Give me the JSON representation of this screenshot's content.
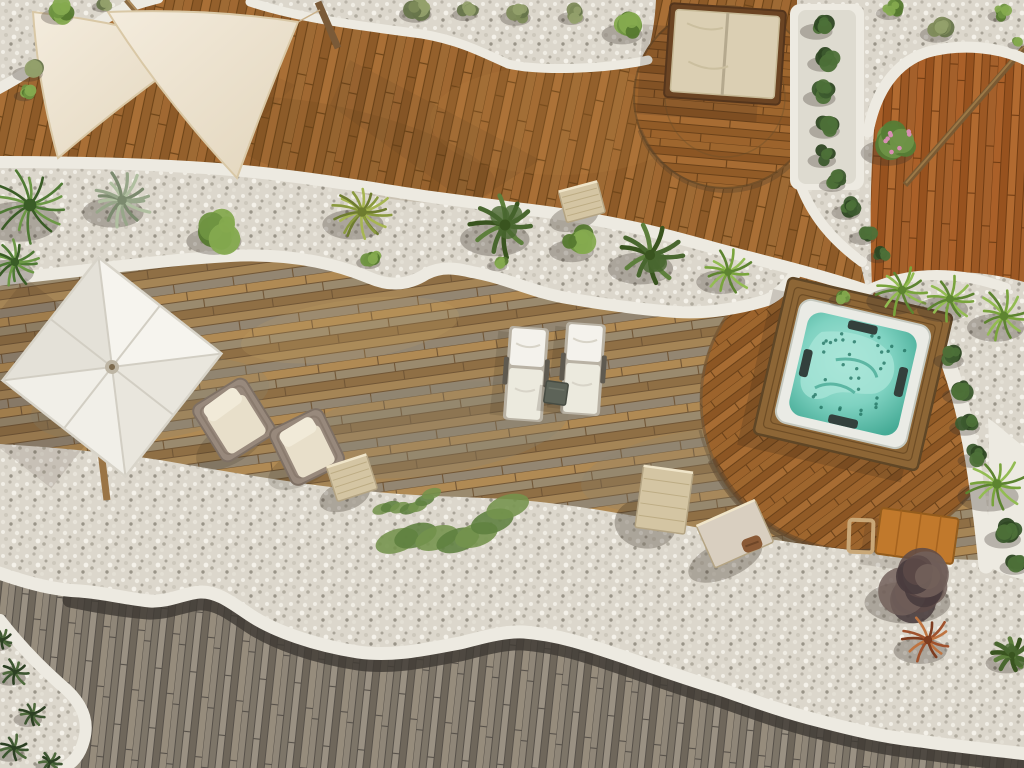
{
  "meta": {
    "title": "Aerial drone view of a curved luxury rooftop terrace with jacuzzi, sun loungers and white pebble beds",
    "description": "Top-down photograph: organic curved wooden decks separated by white concrete curbs and white gravel planting bands, a square hot tub with turquoise water, two white sun loungers, a white square parasol, cream shade sails, a daybed on a circular deck, wicker armchairs and green plants."
  },
  "palette": {
    "gravel": "#dcd7cc",
    "curb": "#edeae1",
    "curb_shadow": "#d6d2c6",
    "deck_upper": "#9b6530",
    "deck_right": "#a35c26",
    "deck_circle": "#975f2a",
    "deck_mid": "#a98a58",
    "deck_lower": "#8c8376",
    "deck_gap_dark": "#3f3b34",
    "sail": "#ece2ce",
    "sail_edge": "#d9c8a6",
    "umbrella": "#f3f1ea",
    "daybed_frame": "#6b4423",
    "daybed_cushion": "#dbcfb3",
    "wicker": "#98897c",
    "cushion": "#e8dfca",
    "lounger": "#f4f2ec",
    "table_dark": "#5d6358",
    "jacuzzi_wood": "#8d6636",
    "jacuzzi_rim": "#eaebe5",
    "water": "#7fd2c1",
    "water_light": "#a9e6d8",
    "water_deep": "#46ab96",
    "jet_dot": "#1f6f5e",
    "bench": "#c1792c",
    "stone": "#d4c5a3",
    "slab": "#d9cfc0",
    "towel": "#8a5a36",
    "shadow": "#2e2418",
    "pole_wood": "#8a6a42"
  },
  "scene": {
    "plant_styles": {
      "bush": [
        "#6f9441",
        "#85aa4f",
        "#55782f"
      ],
      "olive-bush": [
        "#7d8a58",
        "#93a06b",
        "#66744a"
      ],
      "hedge": [
        "#3c5a2e",
        "#4d7038",
        "#2e4723"
      ],
      "flower-bush": [
        "#567c36",
        "#6f9447",
        "#d88fb4"
      ],
      "shrub-dark": [
        "#5d4a48",
        "#72605a",
        "#463a3c"
      ],
      "fern": [
        "#49672f",
        "#5d7f3c",
        "#39541f"
      ],
      "fan-palm": [
        "#4f7a34",
        "#6c9845",
        "#3a5c26"
      ],
      "palm-frond": [
        "#79a43c",
        "#93bc52",
        "#5d8430"
      ],
      "agave": [
        "#97a689",
        "#b0bfa0",
        "#7b8a6e"
      ],
      "yucca": [
        "#8a9a3e",
        "#a7b652",
        "#6e7c2f"
      ],
      "creeper": [
        "#5d7f3f",
        "#74934c",
        "#49672f"
      ],
      "grass-tuft": [
        "#3c5530",
        "#4e6a3c",
        "#2c4023"
      ],
      "red-grass": [
        "#a0522d",
        "#bf7440",
        "#7e3c1f"
      ]
    },
    "plants": [
      {
        "kind": "fan-palm",
        "x": 30,
        "y": 205,
        "r": 40
      },
      {
        "kind": "fan-palm",
        "x": 15,
        "y": 262,
        "r": 26
      },
      {
        "kind": "agave",
        "x": 122,
        "y": 200,
        "r": 30
      },
      {
        "kind": "bush",
        "x": 222,
        "y": 230,
        "r": 27
      },
      {
        "kind": "yucca",
        "x": 362,
        "y": 212,
        "r": 30
      },
      {
        "kind": "fern",
        "x": 505,
        "y": 225,
        "r": 34
      },
      {
        "kind": "bush",
        "x": 578,
        "y": 242,
        "r": 22
      },
      {
        "kind": "fern",
        "x": 650,
        "y": 255,
        "r": 32
      },
      {
        "kind": "palm-frond",
        "x": 728,
        "y": 272,
        "r": 24
      },
      {
        "kind": "bush",
        "x": 843,
        "y": 296,
        "r": 11
      },
      {
        "kind": "bush",
        "x": 372,
        "y": 258,
        "r": 12
      },
      {
        "kind": "bush",
        "x": 500,
        "y": 262,
        "r": 10
      },
      {
        "kind": "olive-bush",
        "x": 420,
        "y": 8,
        "r": 16
      },
      {
        "kind": "olive-bush",
        "x": 468,
        "y": 10,
        "r": 12
      },
      {
        "kind": "olive-bush",
        "x": 520,
        "y": 12,
        "r": 15
      },
      {
        "kind": "olive-bush",
        "x": 575,
        "y": 13,
        "r": 13
      },
      {
        "kind": "bush",
        "x": 628,
        "y": 26,
        "r": 20
      },
      {
        "kind": "olive-bush",
        "x": 32,
        "y": 68,
        "r": 15
      },
      {
        "kind": "bush",
        "x": 27,
        "y": 92,
        "r": 10
      },
      {
        "kind": "bush",
        "x": 62,
        "y": 10,
        "r": 16
      },
      {
        "kind": "olive-bush",
        "x": 105,
        "y": 3,
        "r": 10
      },
      {
        "kind": "bush",
        "x": 893,
        "y": 8,
        "r": 13
      },
      {
        "kind": "olive-bush",
        "x": 941,
        "y": 28,
        "r": 16
      },
      {
        "kind": "bush",
        "x": 1002,
        "y": 12,
        "r": 11
      },
      {
        "kind": "bush",
        "x": 1018,
        "y": 42,
        "r": 8
      },
      {
        "kind": "flower-bush",
        "x": 895,
        "y": 142,
        "r": 26
      },
      {
        "kind": "hedge",
        "x": 821,
        "y": 25,
        "r": 16
      },
      {
        "kind": "hedge",
        "x": 827,
        "y": 58,
        "r": 15
      },
      {
        "kind": "hedge",
        "x": 824,
        "y": 92,
        "r": 16
      },
      {
        "kind": "hedge",
        "x": 829,
        "y": 125,
        "r": 15
      },
      {
        "kind": "hedge",
        "x": 826,
        "y": 155,
        "r": 14
      },
      {
        "kind": "hedge",
        "x": 836,
        "y": 180,
        "r": 13
      },
      {
        "kind": "hedge",
        "x": 850,
        "y": 207,
        "r": 14
      },
      {
        "kind": "hedge",
        "x": 866,
        "y": 233,
        "r": 13
      },
      {
        "kind": "hedge",
        "x": 881,
        "y": 253,
        "r": 11
      },
      {
        "kind": "palm-frond",
        "x": 902,
        "y": 290,
        "r": 27
      },
      {
        "kind": "palm-frond",
        "x": 950,
        "y": 299,
        "r": 25
      },
      {
        "kind": "palm-frond",
        "x": 1004,
        "y": 316,
        "r": 28
      },
      {
        "kind": "hedge",
        "x": 953,
        "y": 355,
        "r": 15
      },
      {
        "kind": "hedge",
        "x": 962,
        "y": 390,
        "r": 15
      },
      {
        "kind": "hedge",
        "x": 969,
        "y": 422,
        "r": 15
      },
      {
        "kind": "hedge",
        "x": 976,
        "y": 455,
        "r": 14
      },
      {
        "kind": "palm-frond",
        "x": 997,
        "y": 484,
        "r": 30
      },
      {
        "kind": "hedge",
        "x": 1008,
        "y": 532,
        "r": 18
      },
      {
        "kind": "hedge",
        "x": 1018,
        "y": 562,
        "r": 14
      },
      {
        "kind": "creeper",
        "x": 455,
        "y": 532,
        "r": 58
      },
      {
        "kind": "creeper",
        "x": 408,
        "y": 505,
        "r": 26
      },
      {
        "kind": "shrub-dark",
        "x": 920,
        "y": 585,
        "r": 42
      },
      {
        "kind": "red-grass",
        "x": 928,
        "y": 640,
        "r": 26
      },
      {
        "kind": "fern",
        "x": 1012,
        "y": 655,
        "r": 20
      },
      {
        "kind": "grass-tuft",
        "x": 15,
        "y": 672,
        "r": 15
      },
      {
        "kind": "grass-tuft",
        "x": 32,
        "y": 714,
        "r": 14
      },
      {
        "kind": "grass-tuft",
        "x": 14,
        "y": 748,
        "r": 15
      },
      {
        "kind": "grass-tuft",
        "x": 50,
        "y": 762,
        "r": 11
      },
      {
        "kind": "grass-tuft",
        "x": 2,
        "y": 640,
        "r": 12
      }
    ],
    "stones": [
      {
        "kind": "cube",
        "x": 582,
        "y": 202,
        "w": 40,
        "h": 32,
        "rot": -15
      },
      {
        "kind": "cube",
        "x": 352,
        "y": 478,
        "w": 42,
        "h": 36,
        "rot": -18
      },
      {
        "kind": "cube",
        "x": 664,
        "y": 500,
        "w": 50,
        "h": 62,
        "rot": 8
      },
      {
        "kind": "slab",
        "x": 735,
        "y": 534,
        "w": 64,
        "h": 46,
        "rot": -24
      },
      {
        "kind": "towel",
        "x": 752,
        "y": 544,
        "w": 20,
        "h": 14,
        "rot": -20
      }
    ],
    "furniture": {
      "parasol": {
        "x": 112,
        "y": 367,
        "rotation": 38
      },
      "daybed": {
        "x": 725,
        "y": 54,
        "rotation": 4
      },
      "armchair_a": {
        "x": 234,
        "y": 420,
        "rotation": -32
      },
      "armchair_b": {
        "x": 307,
        "y": 447,
        "rotation": -26
      },
      "lounger_a": {
        "x": 526,
        "y": 374,
        "rotation": 4
      },
      "lounger_b": {
        "x": 583,
        "y": 369,
        "rotation": 4
      },
      "side_table": {
        "x": 556,
        "y": 393,
        "rotation": 8
      },
      "jacuzzi": {
        "x": 853,
        "y": 374,
        "rotation": 13,
        "jets": 34
      },
      "bench": {
        "x": 917,
        "y": 536,
        "rotation": 8
      }
    },
    "shade_sails": {
      "count": 2
    }
  }
}
